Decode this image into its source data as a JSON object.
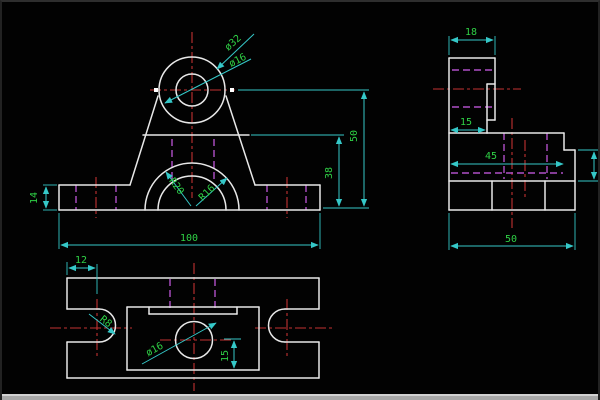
{
  "colors": {
    "background": "#020202",
    "geometry": "#e8e8e8",
    "dimension": "#35c8c8",
    "dimension_text": "#2fd146",
    "centerline": "#c23232",
    "hidden": "#b050c8",
    "bottom_strip": "#a8a8a8"
  },
  "drawing": {
    "front_view": {
      "labels": {
        "boss_outer_dia": "ø32",
        "boss_inner_dia": "ø16",
        "arch_outer_radius": "R20",
        "arch_inner_radius": "R16",
        "base_height": "14",
        "total_width": "100",
        "mid_height": "38",
        "center_height": "50"
      }
    },
    "side_view": {
      "labels": {
        "boss_width": "18",
        "step_depth": "15",
        "mid_depth": "45",
        "total_depth": "50"
      }
    },
    "top_view": {
      "labels": {
        "slot_offset": "12",
        "slot_radius": "R8",
        "hole_dia": "ø16",
        "hole_to_edge": "15"
      }
    }
  }
}
